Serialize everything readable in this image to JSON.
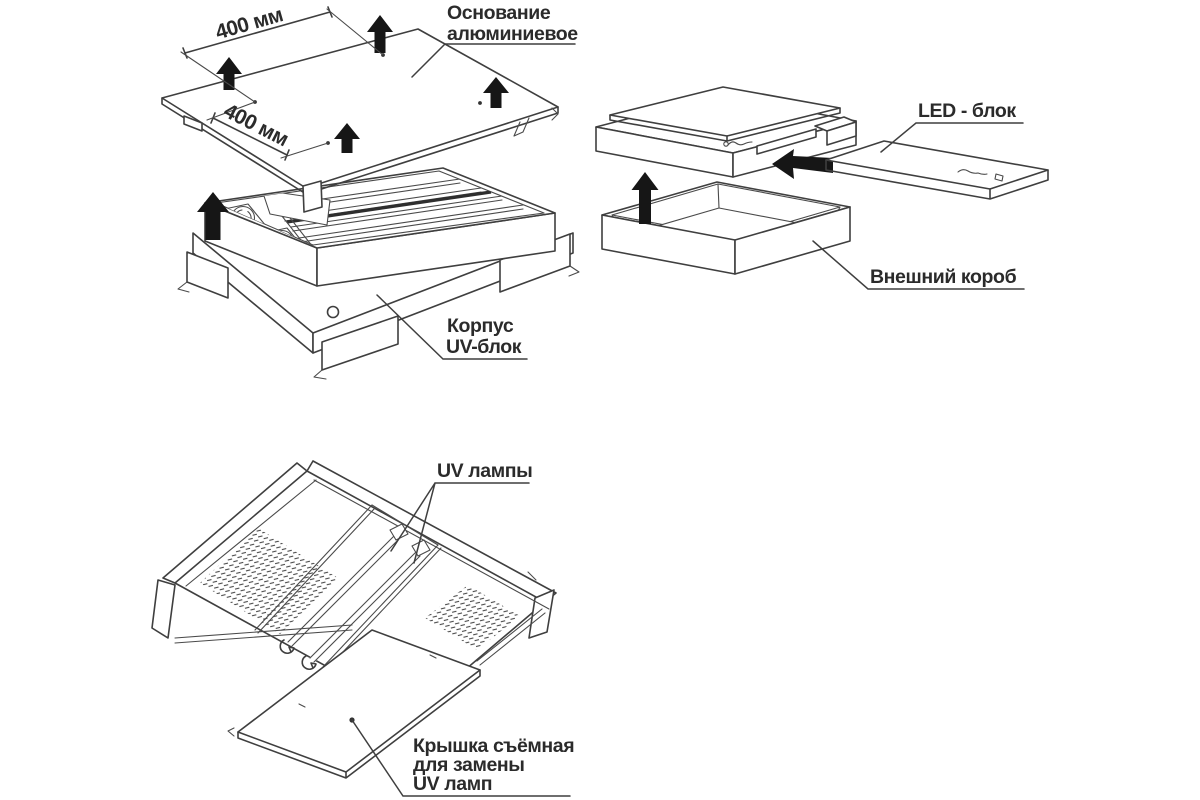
{
  "palette": {
    "background": "#ffffff",
    "line": "#3f3f3f",
    "text": "#2b2b2b",
    "arrow": "#161616",
    "dark_channel": "#2e2e2e"
  },
  "uv_block": {
    "dim_width": "400 мм",
    "dim_depth": "400 мм",
    "label_base_line1": "Основание",
    "label_base_line2": "алюминиевое",
    "label_housing_line1": "Корпус",
    "label_housing_line2": "UV-блок"
  },
  "led_block": {
    "label_led": "LED - блок",
    "label_box": "Внешний короб"
  },
  "lamp_view": {
    "label_lamps": "UV лампы",
    "label_cover_line1": "Крышка съёмная",
    "label_cover_line2": "для замены",
    "label_cover_line3": "UV ламп"
  }
}
